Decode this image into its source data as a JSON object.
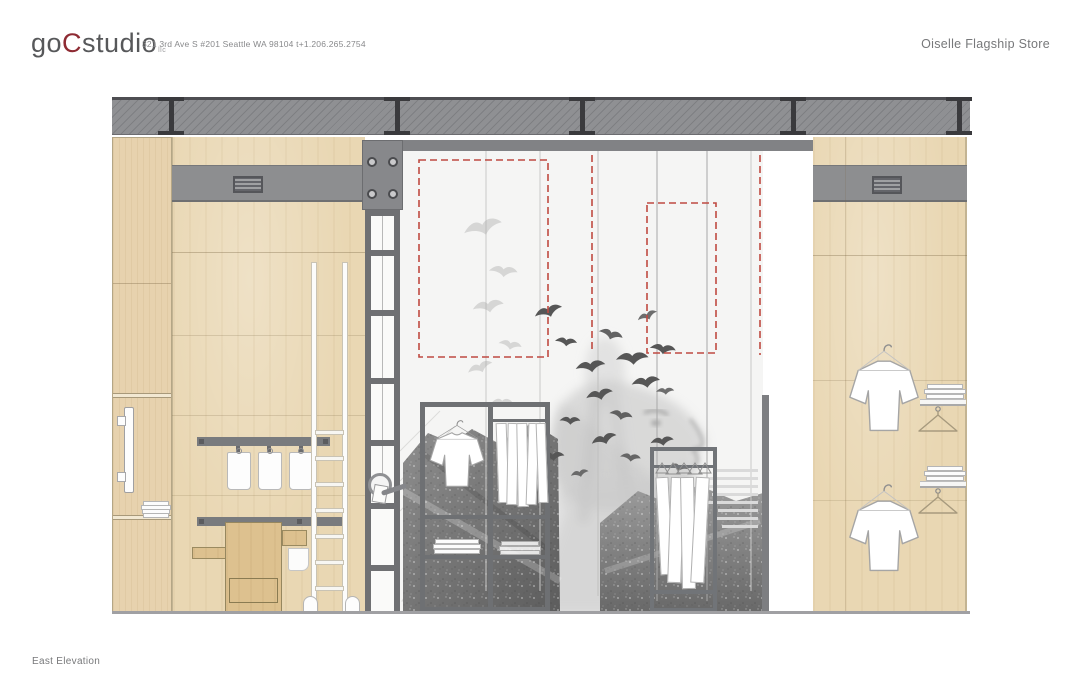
{
  "header": {
    "logo": {
      "prefix": "go",
      "accent": "C",
      "suffix": "studio",
      "sub": "llc"
    },
    "address": "321 3rd Ave S #201 Seattle WA 98104 t+1.206.265.2754",
    "project_title": "Oiselle Flagship Store"
  },
  "footer": {
    "drawing_label": "East Elevation"
  },
  "drawing": {
    "type": "architectural-elevation",
    "subject": "retail interior east wall with wood millwork, steel ladder column, central photographic mural, garment display racks",
    "colors": {
      "wood": "#e9d7b3",
      "wood_dark": "#ddc18f",
      "beam_gray": "#8f9093",
      "steel_dark": "#3a3a3d",
      "duct_gray": "#8d8e90",
      "red_dashline": "#bf4a41",
      "mural_background": "#f5f5f4",
      "annotation_gray": "#77787a",
      "logo_red": "#8e2b33"
    }
  }
}
